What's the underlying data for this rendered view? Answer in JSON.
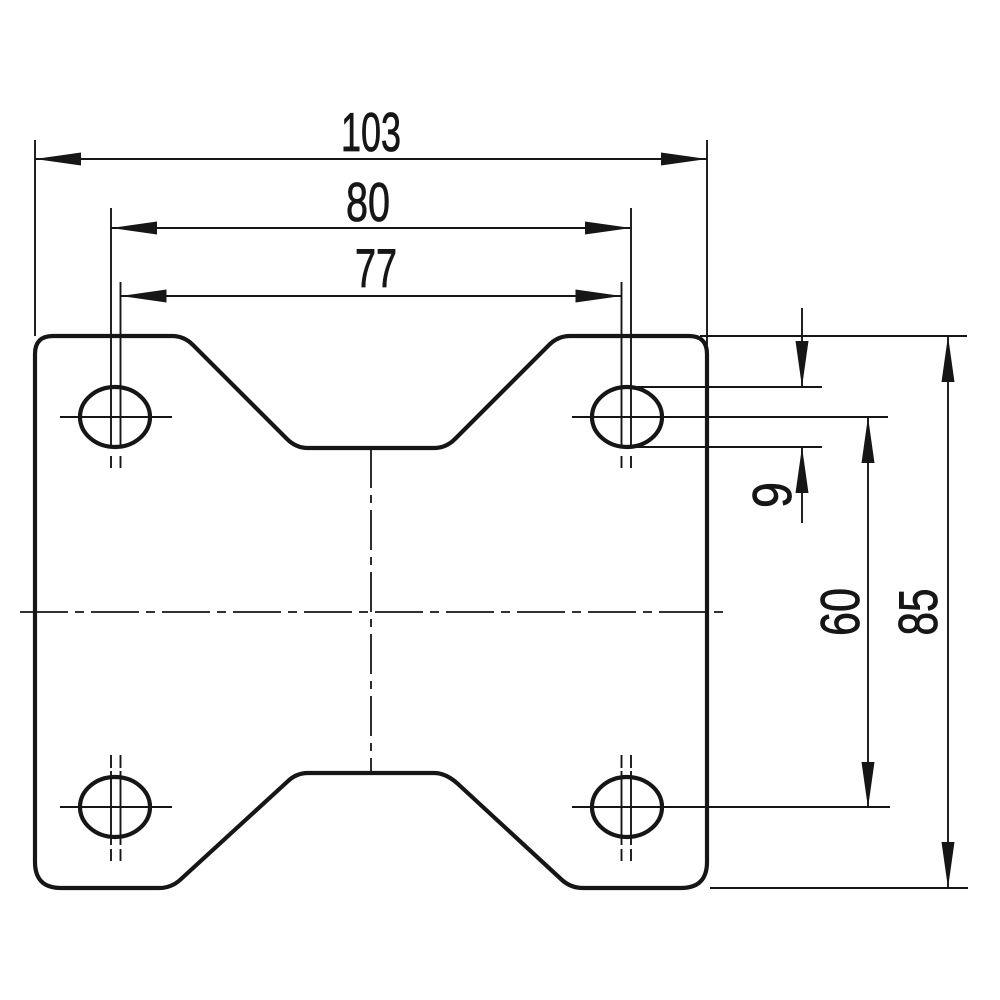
{
  "drawing": {
    "kind": "technical-dimension-drawing",
    "subject": "caster-mounting-plate-top-view",
    "units": "mm",
    "colors": {
      "ink": "#161616",
      "background": "#ffffff"
    }
  },
  "dimensions": [
    {
      "id": "outer-width",
      "label": "103",
      "value": 103,
      "unit": "mm",
      "orientation": "horizontal",
      "measures": "overall plate width"
    },
    {
      "id": "hole-spacing-outer",
      "label": "80",
      "value": 80,
      "unit": "mm",
      "orientation": "horizontal",
      "measures": "bolt hole spacing maximum"
    },
    {
      "id": "hole-spacing-inner",
      "label": "77",
      "value": 77,
      "unit": "mm",
      "orientation": "horizontal",
      "measures": "bolt hole spacing minimum"
    },
    {
      "id": "hole-height",
      "label": "9",
      "value": 9,
      "unit": "mm",
      "orientation": "vertical",
      "measures": "bolt hole slot height"
    },
    {
      "id": "hole-spacing-vertical",
      "label": "60",
      "value": 60,
      "unit": "mm",
      "orientation": "vertical",
      "measures": "bolt hole vertical spacing"
    },
    {
      "id": "outer-height",
      "label": "85",
      "value": 85,
      "unit": "mm",
      "orientation": "vertical",
      "measures": "overall plate height"
    }
  ],
  "features": {
    "holes": {
      "count": 4,
      "shape": "slotted-oval"
    },
    "notches": {
      "count": 2,
      "shape": "trapezoidal",
      "locations": "top and bottom edges"
    }
  }
}
